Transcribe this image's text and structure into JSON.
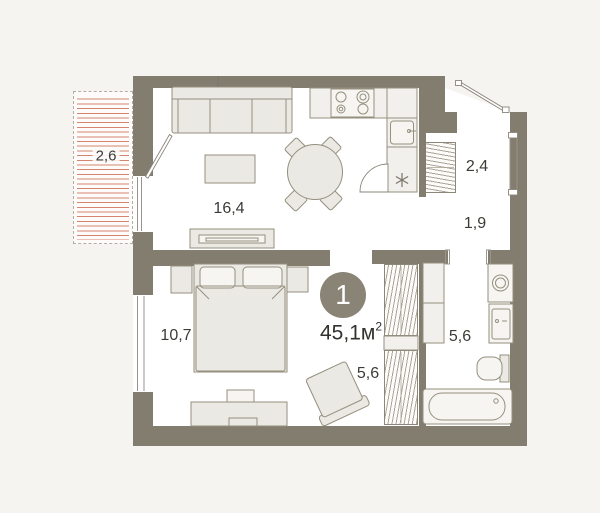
{
  "plan": {
    "apartment_number": "1",
    "area": {
      "value": "45,1",
      "unit": "м",
      "sup": "2"
    },
    "rooms": {
      "balcony": {
        "name": "balcony",
        "label": "2,6"
      },
      "living_kitchen": {
        "name": "living-kitchen",
        "label": "16,4"
      },
      "entry_hall": {
        "name": "entry-hall",
        "label": "2,4"
      },
      "corridor": {
        "name": "corridor",
        "label": "1,9"
      },
      "bedroom": {
        "name": "bedroom",
        "label": "10,7"
      },
      "inner_hall": {
        "name": "inner-hall",
        "label": "5,6"
      },
      "bathroom": {
        "name": "bathroom",
        "label": "5,6"
      }
    },
    "colors": {
      "canvas": "#f5f4f0",
      "floor": "#ffffff",
      "wall": "#837d70",
      "badge": "#8a8477",
      "text": "#3c3b36",
      "furniture-fill": "#eae9e4",
      "furniture-stroke": "#95907e",
      "hatch-red": "#d5846f"
    }
  }
}
